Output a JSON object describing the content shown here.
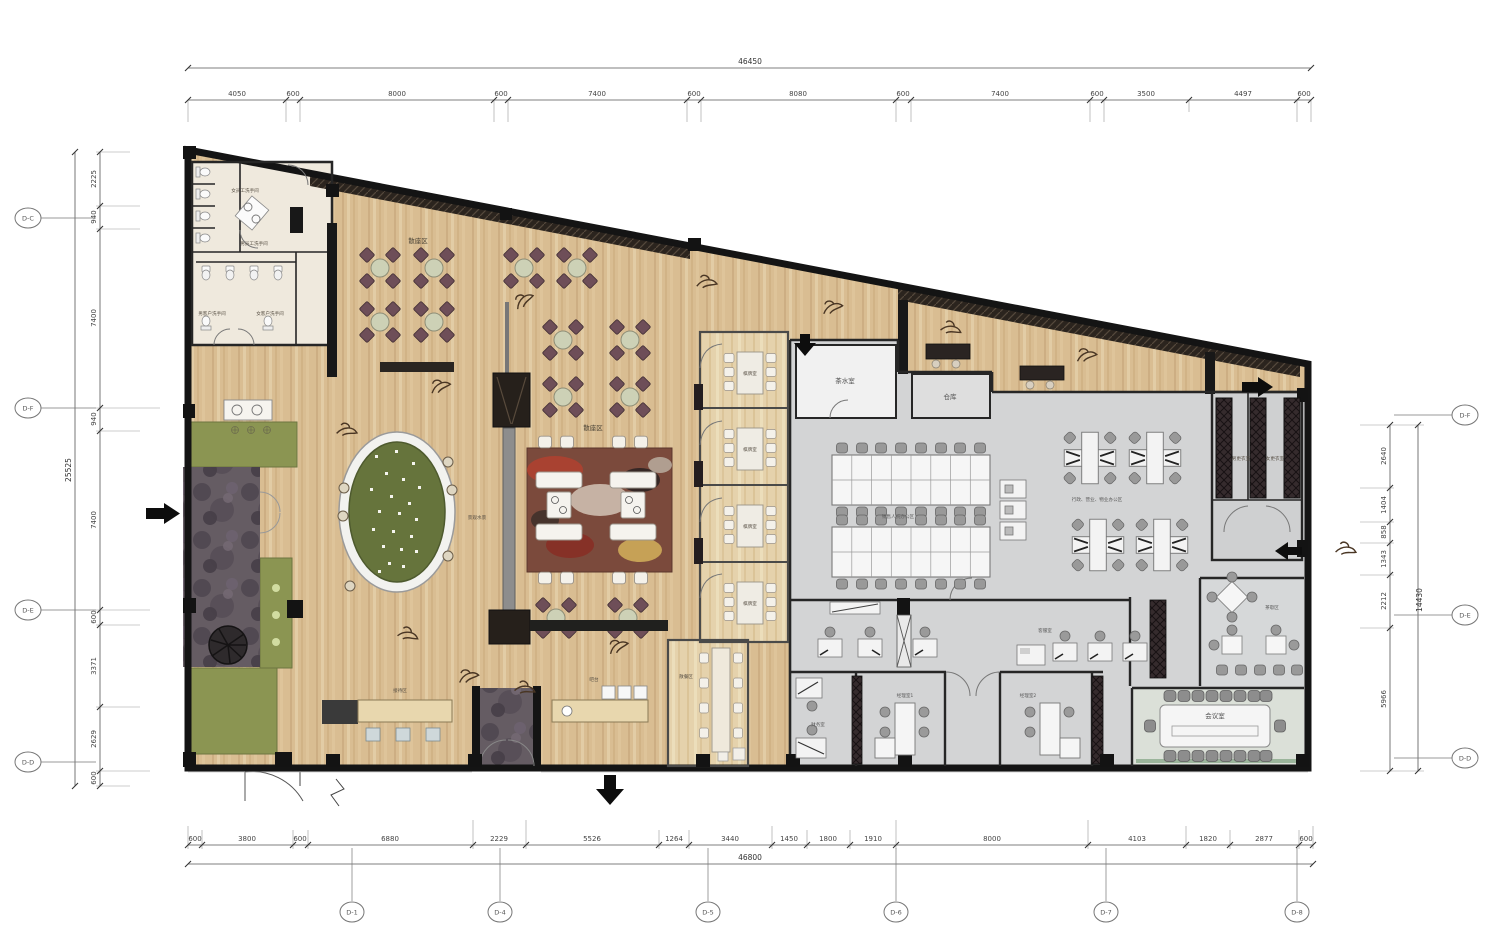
{
  "dims": {
    "top": {
      "overall": "46450",
      "segments": [
        "4050",
        "600",
        "8000",
        "600",
        "7400",
        "600",
        "8080",
        "600",
        "7400",
        "600",
        "3500",
        "4497",
        "600"
      ]
    },
    "bottom": {
      "overall": "46800",
      "segments": [
        "600",
        "3800",
        "600",
        "6880",
        "2229",
        "5526",
        "1264",
        "3440",
        "1450",
        "1800",
        "1910",
        "8000",
        "4103",
        "1820",
        "2877",
        "600"
      ]
    },
    "left": {
      "overall": "25525",
      "segments": [
        "2225",
        "940",
        "7400",
        "940",
        "7400",
        "600",
        "3371",
        "2629",
        "600"
      ]
    },
    "right": {
      "overall": "14430",
      "segments": [
        "2640",
        "1404",
        "858",
        "1343",
        "2212",
        "5966"
      ]
    }
  },
  "grid": {
    "left": [
      "D-C",
      "D-F",
      "D-E",
      "D-D"
    ],
    "right": [
      "D-F",
      "D-E",
      "D-D"
    ],
    "bottom": [
      "D-1",
      "D-4",
      "D-5",
      "D-6",
      "D-7",
      "D-8"
    ]
  },
  "rooms": {
    "seating_a": "散座区",
    "seating_b": "散座区",
    "female_staff_wc": "女员工洗手间",
    "male_staff_wc": "男员工洗手间",
    "male_guest_wc": "男客户洗手间",
    "female_guest_wc": "女客户洗手间",
    "water_feature": "景观水景",
    "private_room": "棋牌室",
    "casual_dining": "散餐区",
    "reception": "接待区",
    "bar": "吧台",
    "tea_room": "茶水室",
    "storage": "仓库",
    "sales_office": "销售人员办公区",
    "admin_office": "行政、营业、物业办公区",
    "customer_service": "客服室",
    "manager_1": "经理室1",
    "manager_2": "经理室2",
    "finance": "财务室",
    "meeting": "会议室",
    "tea_break": "茶歇区",
    "male_locker": "男更衣室",
    "female_locker": "女更衣室"
  },
  "colors": {
    "wood": "#d9bd92",
    "office_floor": "#d3d4d5",
    "planter": "#8b9552",
    "stone": "#655c63",
    "pond": "#66743c",
    "dining_chair": "#6e4e58",
    "wall": "#1c1c1c"
  }
}
